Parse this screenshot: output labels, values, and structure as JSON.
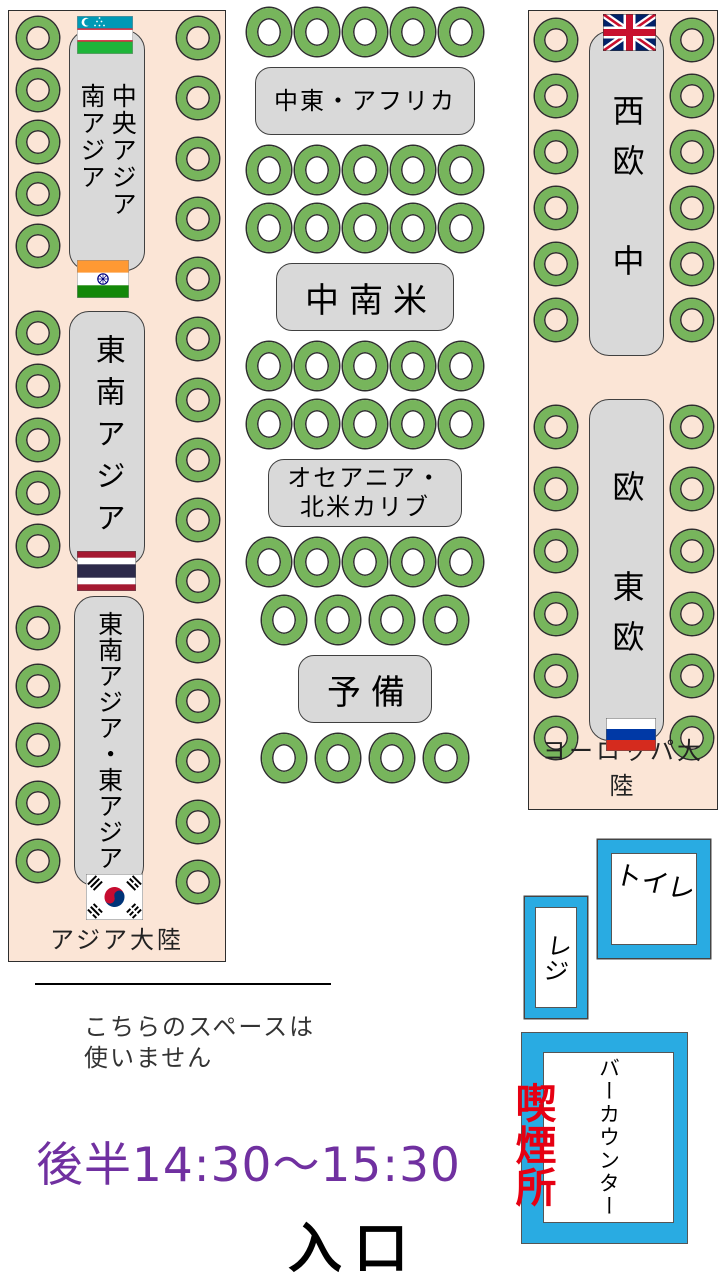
{
  "colors": {
    "room_fill": "#fbe5d6",
    "seat_green": "#77b55c",
    "table_gray": "#d9d9d9",
    "facility_blue": "#29abe2",
    "smoking_red": "#e60012",
    "time_purple": "#7030a0"
  },
  "asia": {
    "continent_label": "アジア大陸",
    "table1_label": "中央アジア\n南アジア",
    "table2_label": "東南アジア",
    "table3_label": "東南アジア・東アジア",
    "flags": [
      "uzbekistan",
      "india",
      "thailand",
      "south-korea"
    ],
    "seats": {
      "left_groups": [
        5,
        5,
        5
      ],
      "right_groups": [
        15
      ]
    }
  },
  "center": {
    "rows": [
      {
        "type": "seats",
        "count": 5
      },
      {
        "type": "label",
        "text": "中東・アフリカ",
        "size": "small"
      },
      {
        "type": "seats",
        "count": 5
      },
      {
        "type": "seats",
        "count": 5
      },
      {
        "type": "label",
        "text": "中南米",
        "size": "large"
      },
      {
        "type": "seats",
        "count": 5
      },
      {
        "type": "seats",
        "count": 5
      },
      {
        "type": "label",
        "text": "オセアニア・\n北米カリブ",
        "size": "small"
      },
      {
        "type": "seats",
        "count": 5
      },
      {
        "type": "seats",
        "count": 4
      },
      {
        "type": "label",
        "text": "予備",
        "size": "large"
      },
      {
        "type": "seats",
        "count": 4
      }
    ]
  },
  "europe": {
    "continent_label": "ヨーロッパ大陸",
    "table1_label": "西欧　中",
    "table2_label": "欧　東欧",
    "flags": [
      "united-kingdom",
      "russia"
    ],
    "seats": {
      "left_groups": [
        6,
        6
      ],
      "right_groups": [
        6,
        6
      ]
    }
  },
  "facilities": {
    "toilet_label": "トイレ",
    "register_label": "レジ",
    "bar_counter_label": "バーカウンター",
    "smoking_label": "喫煙所"
  },
  "notes": {
    "unused_space": "こちらのスペースは\n使いません",
    "session_time": "後半14:30〜15:30",
    "entrance_label": "入口"
  }
}
